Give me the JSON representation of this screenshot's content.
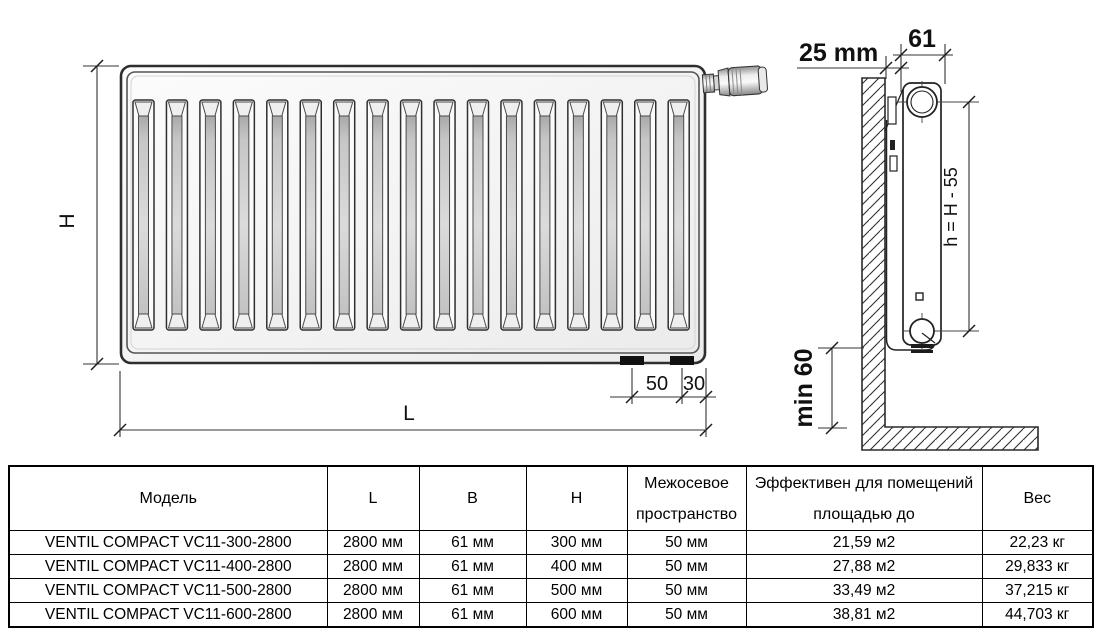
{
  "diagram": {
    "front_view": {
      "height_label": "H",
      "length_label": "L",
      "dim_50": "50",
      "dim_30": "30",
      "groove_count": 17
    },
    "side_view": {
      "wall_gap_label": "25 mm",
      "depth_label": "61",
      "axis_height_label": "h = H - 55",
      "floor_clearance_label": "min 60"
    },
    "colors": {
      "line": "#2b2b2b",
      "radiator_fill": "#f2f2f2",
      "stub_fill": "#111111"
    }
  },
  "table": {
    "headers": [
      "Модель",
      "L",
      "B",
      "H",
      "Межосевое пространство",
      "Эффективен для помещений площадью до",
      "Вес"
    ],
    "rows": [
      [
        "VENTIL COMPACT VC11-300-2800",
        "2800 мм",
        "61 мм",
        "300 мм",
        "50 мм",
        "21,59 м2",
        "22,23 кг"
      ],
      [
        "VENTIL COMPACT VC11-400-2800",
        "2800 мм",
        "61 мм",
        "400 мм",
        "50 мм",
        "27,88 м2",
        "29,833 кг"
      ],
      [
        "VENTIL COMPACT VC11-500-2800",
        "2800 мм",
        "61 мм",
        "500 мм",
        "50 мм",
        "33,49 м2",
        "37,215 кг"
      ],
      [
        "VENTIL COMPACT VC11-600-2800",
        "2800 мм",
        "61 мм",
        "600 мм",
        "50 мм",
        "38,81 м2",
        "44,703 кг"
      ]
    ]
  }
}
